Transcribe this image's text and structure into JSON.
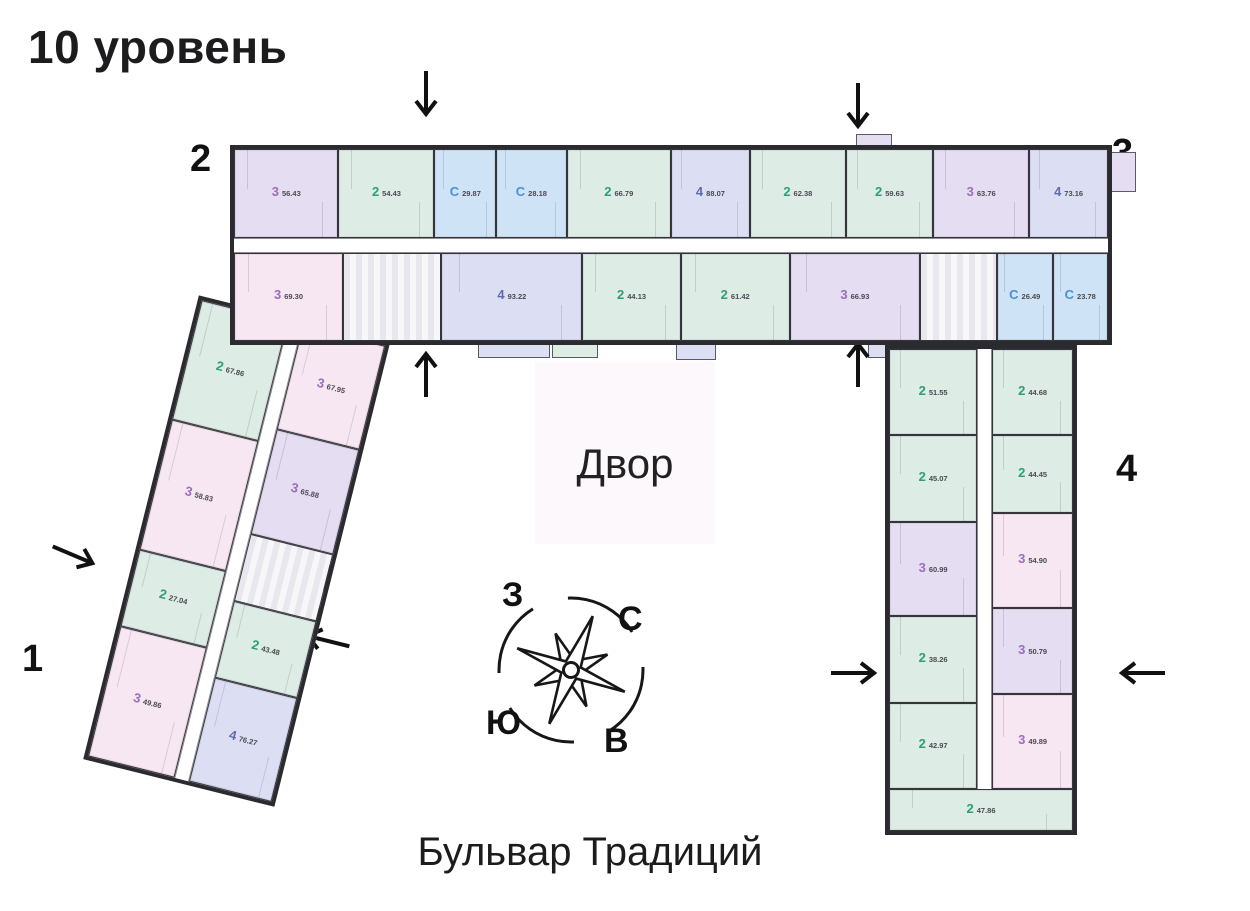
{
  "title": "10 уровень",
  "street": "Бульвар Традиций",
  "courtyard": "Двор",
  "compass": {
    "north": "С",
    "east": "В",
    "south": "Ю",
    "west": "З"
  },
  "sections": {
    "s1": "1",
    "s2": "2",
    "s3": "3",
    "s4": "4"
  },
  "palette": {
    "purple": "#e5ddf1",
    "pink": "#f7e7f2",
    "green": "#ddece5",
    "blue": "#cfe3f6",
    "indigo": "#dcdff3",
    "core": "#f0eef3",
    "wall": "#2b2b2f",
    "courtyard": "#fdf3f9"
  },
  "type_colors": {
    "2": "#2e9e77",
    "3": "#9a6fb8",
    "С": "#4a90d9",
    "4": "#5f6ab0"
  },
  "top_wing": {
    "row_north": [
      {
        "t": "3",
        "a": "56.43",
        "c": "purple",
        "w": 12
      },
      {
        "t": "2",
        "a": "54.43",
        "c": "green",
        "w": 11
      },
      {
        "t": "С",
        "a": "29.87",
        "c": "blue",
        "w": 7
      },
      {
        "t": "С",
        "a": "28.18",
        "c": "blue",
        "w": 8
      },
      {
        "t": "2",
        "a": "66.79",
        "c": "green",
        "w": 12
      },
      {
        "t": "4",
        "a": "88.07",
        "c": "indigo",
        "w": 9
      },
      {
        "t": "2",
        "a": "62.38",
        "c": "green",
        "w": 11
      },
      {
        "t": "2",
        "a": "59.63",
        "c": "green",
        "w": 10
      },
      {
        "t": "3",
        "a": "63.76",
        "c": "purple",
        "w": 11
      },
      {
        "t": "4",
        "a": "73.16",
        "c": "indigo",
        "w": 9
      }
    ],
    "row_south": [
      {
        "t": "3",
        "a": "69.30",
        "c": "pink",
        "w": 10
      },
      {
        "core": true,
        "w": 9
      },
      {
        "t": "4",
        "a": "93.22",
        "c": "indigo",
        "w": 13
      },
      {
        "t": "2",
        "a": "44.13",
        "c": "green",
        "w": 9
      },
      {
        "t": "2",
        "a": "61.42",
        "c": "green",
        "w": 10
      },
      {
        "t": "3",
        "a": "66.93",
        "c": "purple",
        "w": 12
      },
      {
        "core": true,
        "w": 7
      },
      {
        "t": "С",
        "a": "26.49",
        "c": "blue",
        "w": 5
      },
      {
        "t": "С",
        "a": "23.78",
        "c": "blue",
        "w": 5
      }
    ]
  },
  "left_wing": {
    "col_outer": [
      {
        "t": "2",
        "a": "67.86",
        "c": "green",
        "w": 11
      },
      {
        "t": "3",
        "a": "58.83",
        "c": "pink",
        "w": 12
      },
      {
        "t": "2",
        "a": "27.04",
        "c": "green",
        "w": 7
      },
      {
        "t": "3",
        "a": "49.86",
        "c": "pink",
        "w": 12
      }
    ],
    "col_inner": [
      {
        "t": "3",
        "a": "67.95",
        "c": "pink",
        "w": 11
      },
      {
        "t": "3",
        "a": "65.88",
        "c": "purple",
        "w": 11
      },
      {
        "core": true,
        "w": 7
      },
      {
        "t": "2",
        "a": "43.48",
        "c": "green",
        "w": 8
      },
      {
        "t": "4",
        "a": "76.27",
        "c": "indigo",
        "w": 11
      }
    ]
  },
  "right_wing": {
    "col_west": [
      {
        "t": "2",
        "a": "51.55",
        "c": "green",
        "w": 10
      },
      {
        "t": "2",
        "a": "45.07",
        "c": "green",
        "w": 10
      },
      {
        "t": "3",
        "a": "60.99",
        "c": "purple",
        "w": 11
      },
      {
        "t": "2",
        "a": "38.26",
        "c": "green",
        "w": 10
      },
      {
        "t": "2",
        "a": "42.97",
        "c": "green",
        "w": 10
      }
    ],
    "col_east": [
      {
        "t": "2",
        "a": "44.68",
        "c": "green",
        "w": 10
      },
      {
        "t": "2",
        "a": "44.45",
        "c": "green",
        "w": 9
      },
      {
        "t": "3",
        "a": "54.90",
        "c": "pink",
        "w": 11
      },
      {
        "t": "3",
        "a": "50.79",
        "c": "purple",
        "w": 10
      },
      {
        "t": "3",
        "a": "49.89",
        "c": "pink",
        "w": 11
      }
    ],
    "south_unit": {
      "t": "2",
      "a": "47.86",
      "c": "green"
    }
  }
}
